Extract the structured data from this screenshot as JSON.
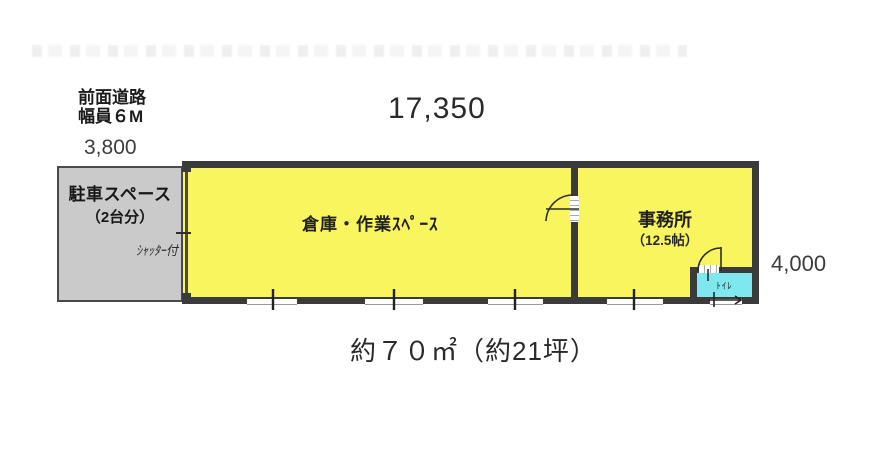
{
  "colors": {
    "wall": "#3b3b3b",
    "room_fill": "#f8f55f",
    "parking_fill": "#cacaca",
    "toilet_fill": "#7fe8ee",
    "dim_text": "#3d3d3d",
    "label_text": "#1c1c1c"
  },
  "annotations": {
    "front_road_line1": "前面道路",
    "front_road_line2": "幅員６M",
    "area_total": "約７０㎡（約21坪）"
  },
  "dimensions": {
    "building_width": "17,350",
    "parking_width": "3,800",
    "building_depth": "4,000"
  },
  "rooms": {
    "parking": {
      "label": "駐車スペース",
      "sublabel": "（2台分）"
    },
    "warehouse": {
      "label": "倉庫・作業ｽﾍﾟｰｽ"
    },
    "office": {
      "label": "事務所",
      "sublabel": "（12.5帖）"
    },
    "toilet": {
      "label": "ﾄｲﾚ"
    }
  },
  "notes": {
    "shutter": "ｼｬｯﾀｰ付"
  }
}
